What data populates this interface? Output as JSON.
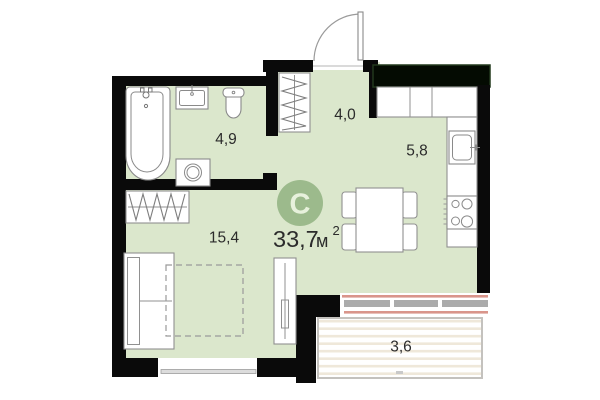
{
  "unit": {
    "type_letter": "C",
    "total_area": "33,7",
    "area_unit": "м",
    "area_sup": "2"
  },
  "rooms": [
    {
      "name": "bathroom",
      "area": "4,9"
    },
    {
      "name": "hallway",
      "area": "4,0"
    },
    {
      "name": "kitchen",
      "area": "5,8"
    },
    {
      "name": "living-room",
      "area": "15,4"
    },
    {
      "name": "balcony",
      "area": "3,6"
    }
  ],
  "colors": {
    "floor": "#dbe7cc",
    "accent": "#9cba8c",
    "wall": "#0a0a0a",
    "wall_green_edge": "#22381c",
    "furniture_stroke": "#909090",
    "fixture_stroke": "#8a8a8a",
    "text": "#2b2b2b",
    "window_pink": "#d9958b",
    "window_bar": "#ababab",
    "balcony_stripe": "#efe8da",
    "balcony_border": "#c4c2be"
  }
}
